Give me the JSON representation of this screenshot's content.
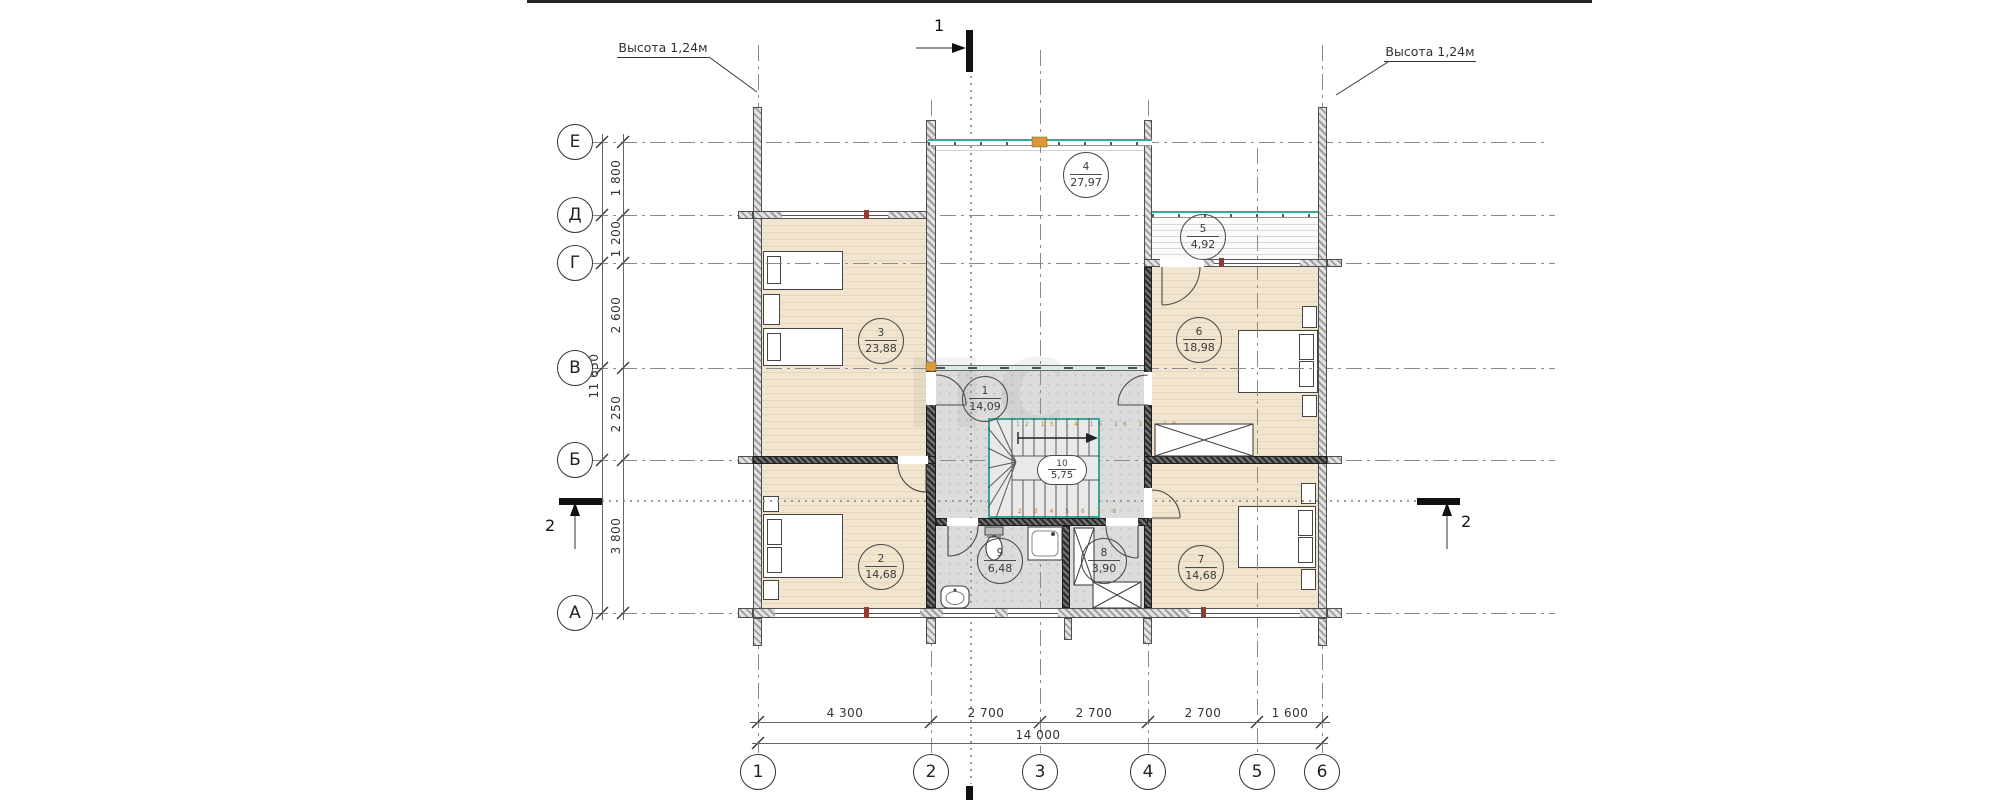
{
  "colors": {
    "accent_teal": "#3aa496",
    "floor_wood": "#f1e4cd",
    "floor_tile": "#dcdcdc",
    "wall_dark": "#3a3a3a",
    "mark_red": "#8e3b35",
    "mark_orange": "#d99a3d"
  },
  "annotations": {
    "height_left": "Высота 1,24м",
    "height_right": "Высота 1,24м"
  },
  "sections": {
    "s1": "1",
    "s2": "2"
  },
  "axes": {
    "rows": [
      "Е",
      "Д",
      "Г",
      "В",
      "Б",
      "А"
    ],
    "cols": [
      "1",
      "2",
      "3",
      "4",
      "5",
      "6"
    ]
  },
  "dims": {
    "left": [
      "1 800",
      "1 200",
      "2 600",
      "2 250",
      "3 800"
    ],
    "left_total": "11 650",
    "bottom": [
      "4 300",
      "2 700",
      "2 700",
      "2 700",
      "1 600"
    ],
    "bottom_total": "14 000"
  },
  "rooms": [
    {
      "num": "1",
      "area": "14,09"
    },
    {
      "num": "2",
      "area": "14,68"
    },
    {
      "num": "3",
      "area": "23,88"
    },
    {
      "num": "4",
      "area": "27,97"
    },
    {
      "num": "5",
      "area": "4,92"
    },
    {
      "num": "6",
      "area": "18,98"
    },
    {
      "num": "7",
      "area": "14,68"
    },
    {
      "num": "8",
      "area": "3,90"
    },
    {
      "num": "9",
      "area": "6,48"
    },
    {
      "num": "10",
      "area": "5,75"
    }
  ],
  "stairs": {
    "top_numbers": "12 13 14 15 16 17 18",
    "bottom_numbers": "2 3 4 5 6 7 8"
  },
  "watermark": "ПС"
}
